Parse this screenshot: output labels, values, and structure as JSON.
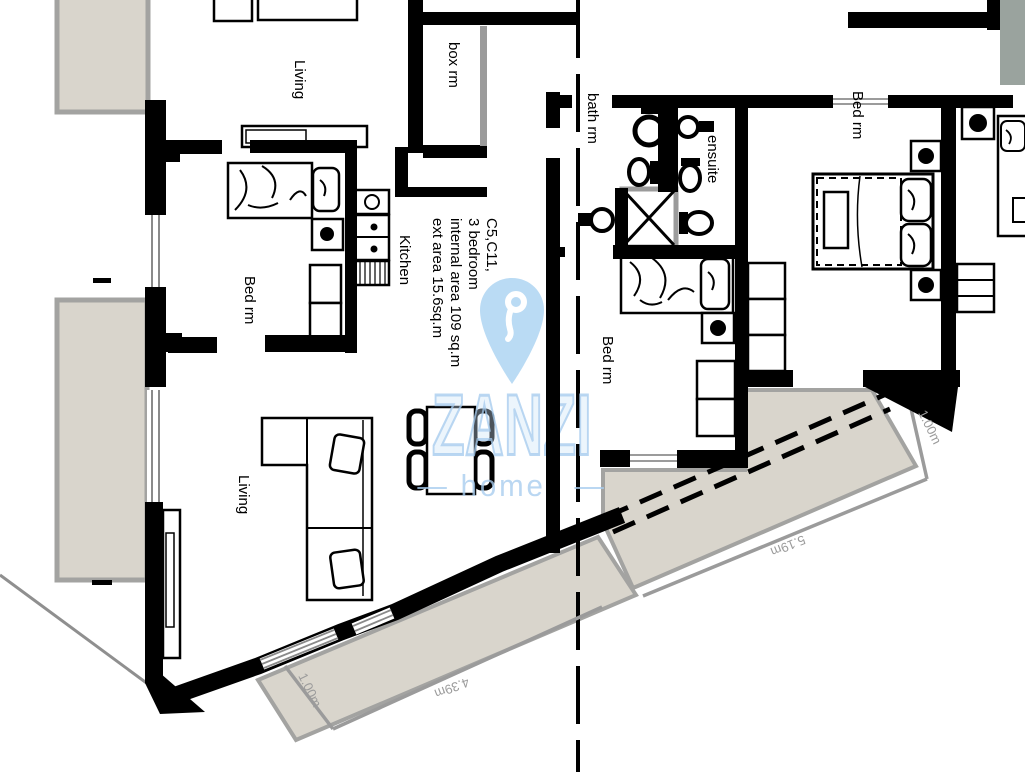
{
  "watermark": {
    "brand": "ZANZI",
    "tagline": "— homes —"
  },
  "unit_info": {
    "lines": [
      "C5,C11,",
      "3 bedroom",
      "internal area 109 sq.m",
      "ext area 15.6sq.m"
    ]
  },
  "rooms": {
    "living_top": "Living",
    "box_rm": "box rm",
    "bath_rm": "bath rm",
    "ensuite": "ensuite",
    "bed_rm_right": "Bed rm",
    "bed_rm_left": "Bed rm",
    "bed_rm_middle": "Bed rm",
    "kitchen": "Kitchen",
    "living_main": "Living"
  },
  "dimensions": {
    "terrace_right_width": "1.00m",
    "terrace_right_length": "5.19m",
    "terrace_bottom_length": "4.39m",
    "terrace_bottom_width": "1.00m"
  },
  "colors": {
    "wall": "#000000",
    "terrace": "#d9d5cc",
    "dimension_gray": "#9b9b9b",
    "watermark_blue": "#aecfeb",
    "pin_blue": "#b5d8f4",
    "shaft_gray_green": "#9aa39e"
  }
}
